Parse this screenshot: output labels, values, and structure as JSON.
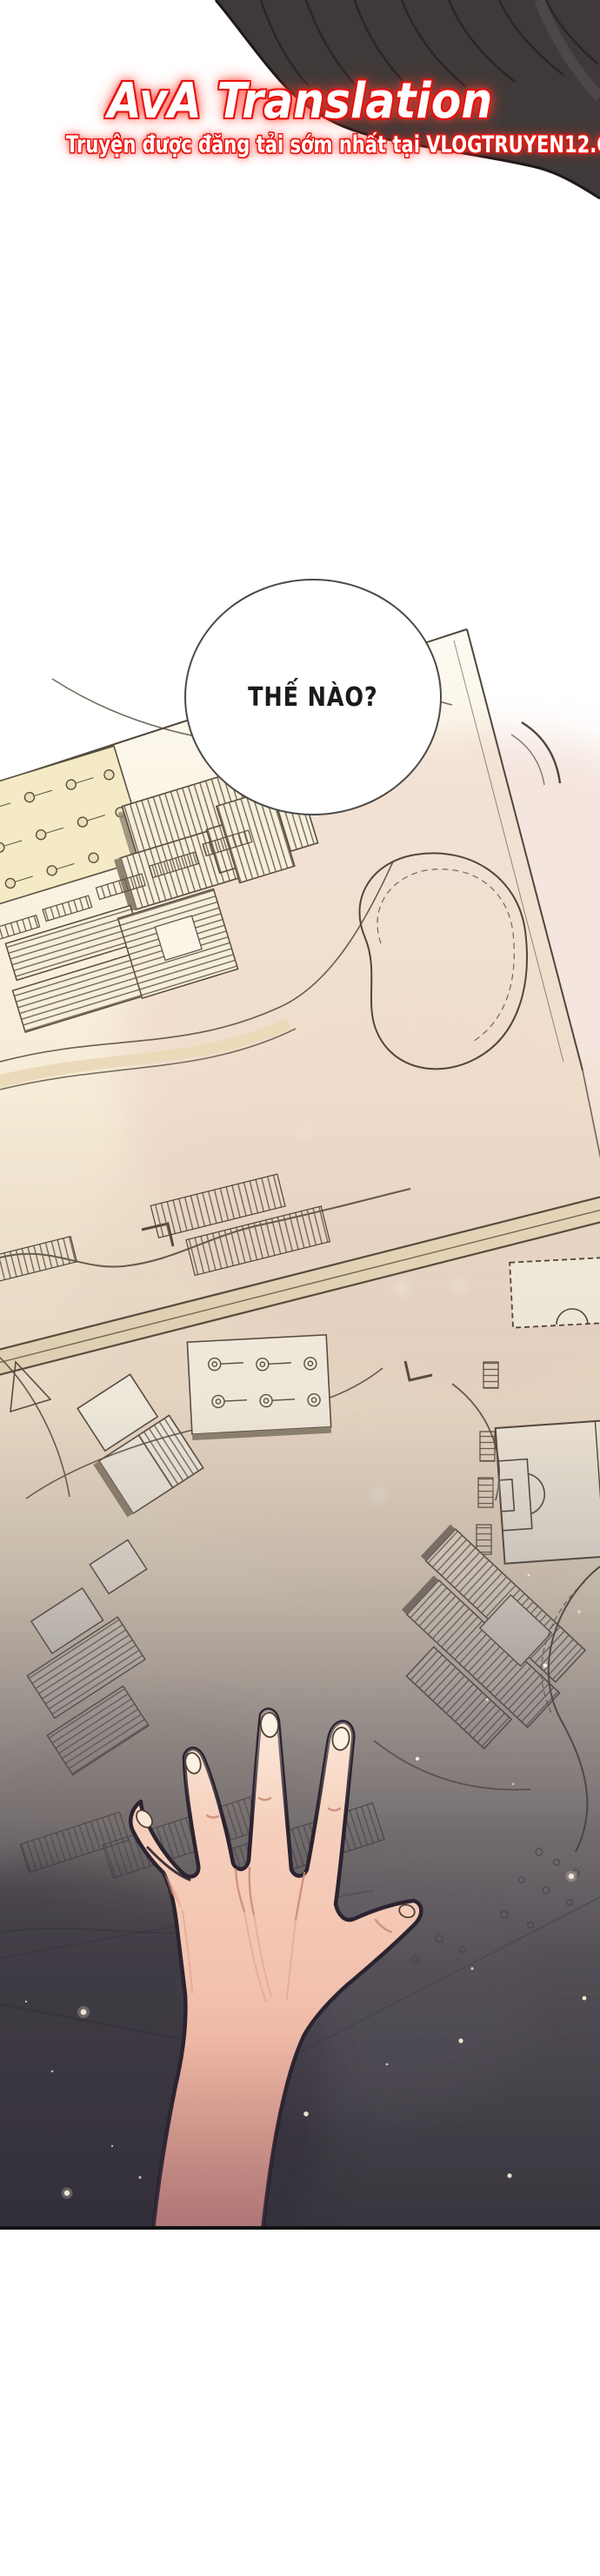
{
  "translator_header": {
    "title": "AvA Translation",
    "subtitle": "Truyện được đăng tải sớm nhất tại VLOGTRUYEN12.COM",
    "text_color": "#ffffff",
    "glow_color": "#e8100c"
  },
  "speech_bubble": {
    "text": "THẾ NÀO?",
    "text_color": "#1a1a1a",
    "fill": "#ffffff",
    "outline_color": "#4a4a4a"
  },
  "scene": {
    "description": "Webtoon panel: a hand reaches over a hand-drawn architectural site plan (campus map with hatched buildings, tree plazas, pond, soccer field, roads and parking) that fades into a starry darkness at the bottom; dark hair silhouette at top-right",
    "colors": {
      "panel_background": "#ffffff",
      "map_paper": "#f9f3e2",
      "map_warm_tint": "#eed7ca",
      "map_plaza_yellow": "#f4ebc6",
      "map_ink": "#56493c",
      "map_shadow_tan": "#8e8370",
      "night_overlay": "#34323e",
      "star": "#fff6e3",
      "hair": "#3f3a39",
      "skin": "#f4c9b6",
      "skin_shadow": "#e59e88",
      "line_art_outline": "#2b2330"
    }
  }
}
